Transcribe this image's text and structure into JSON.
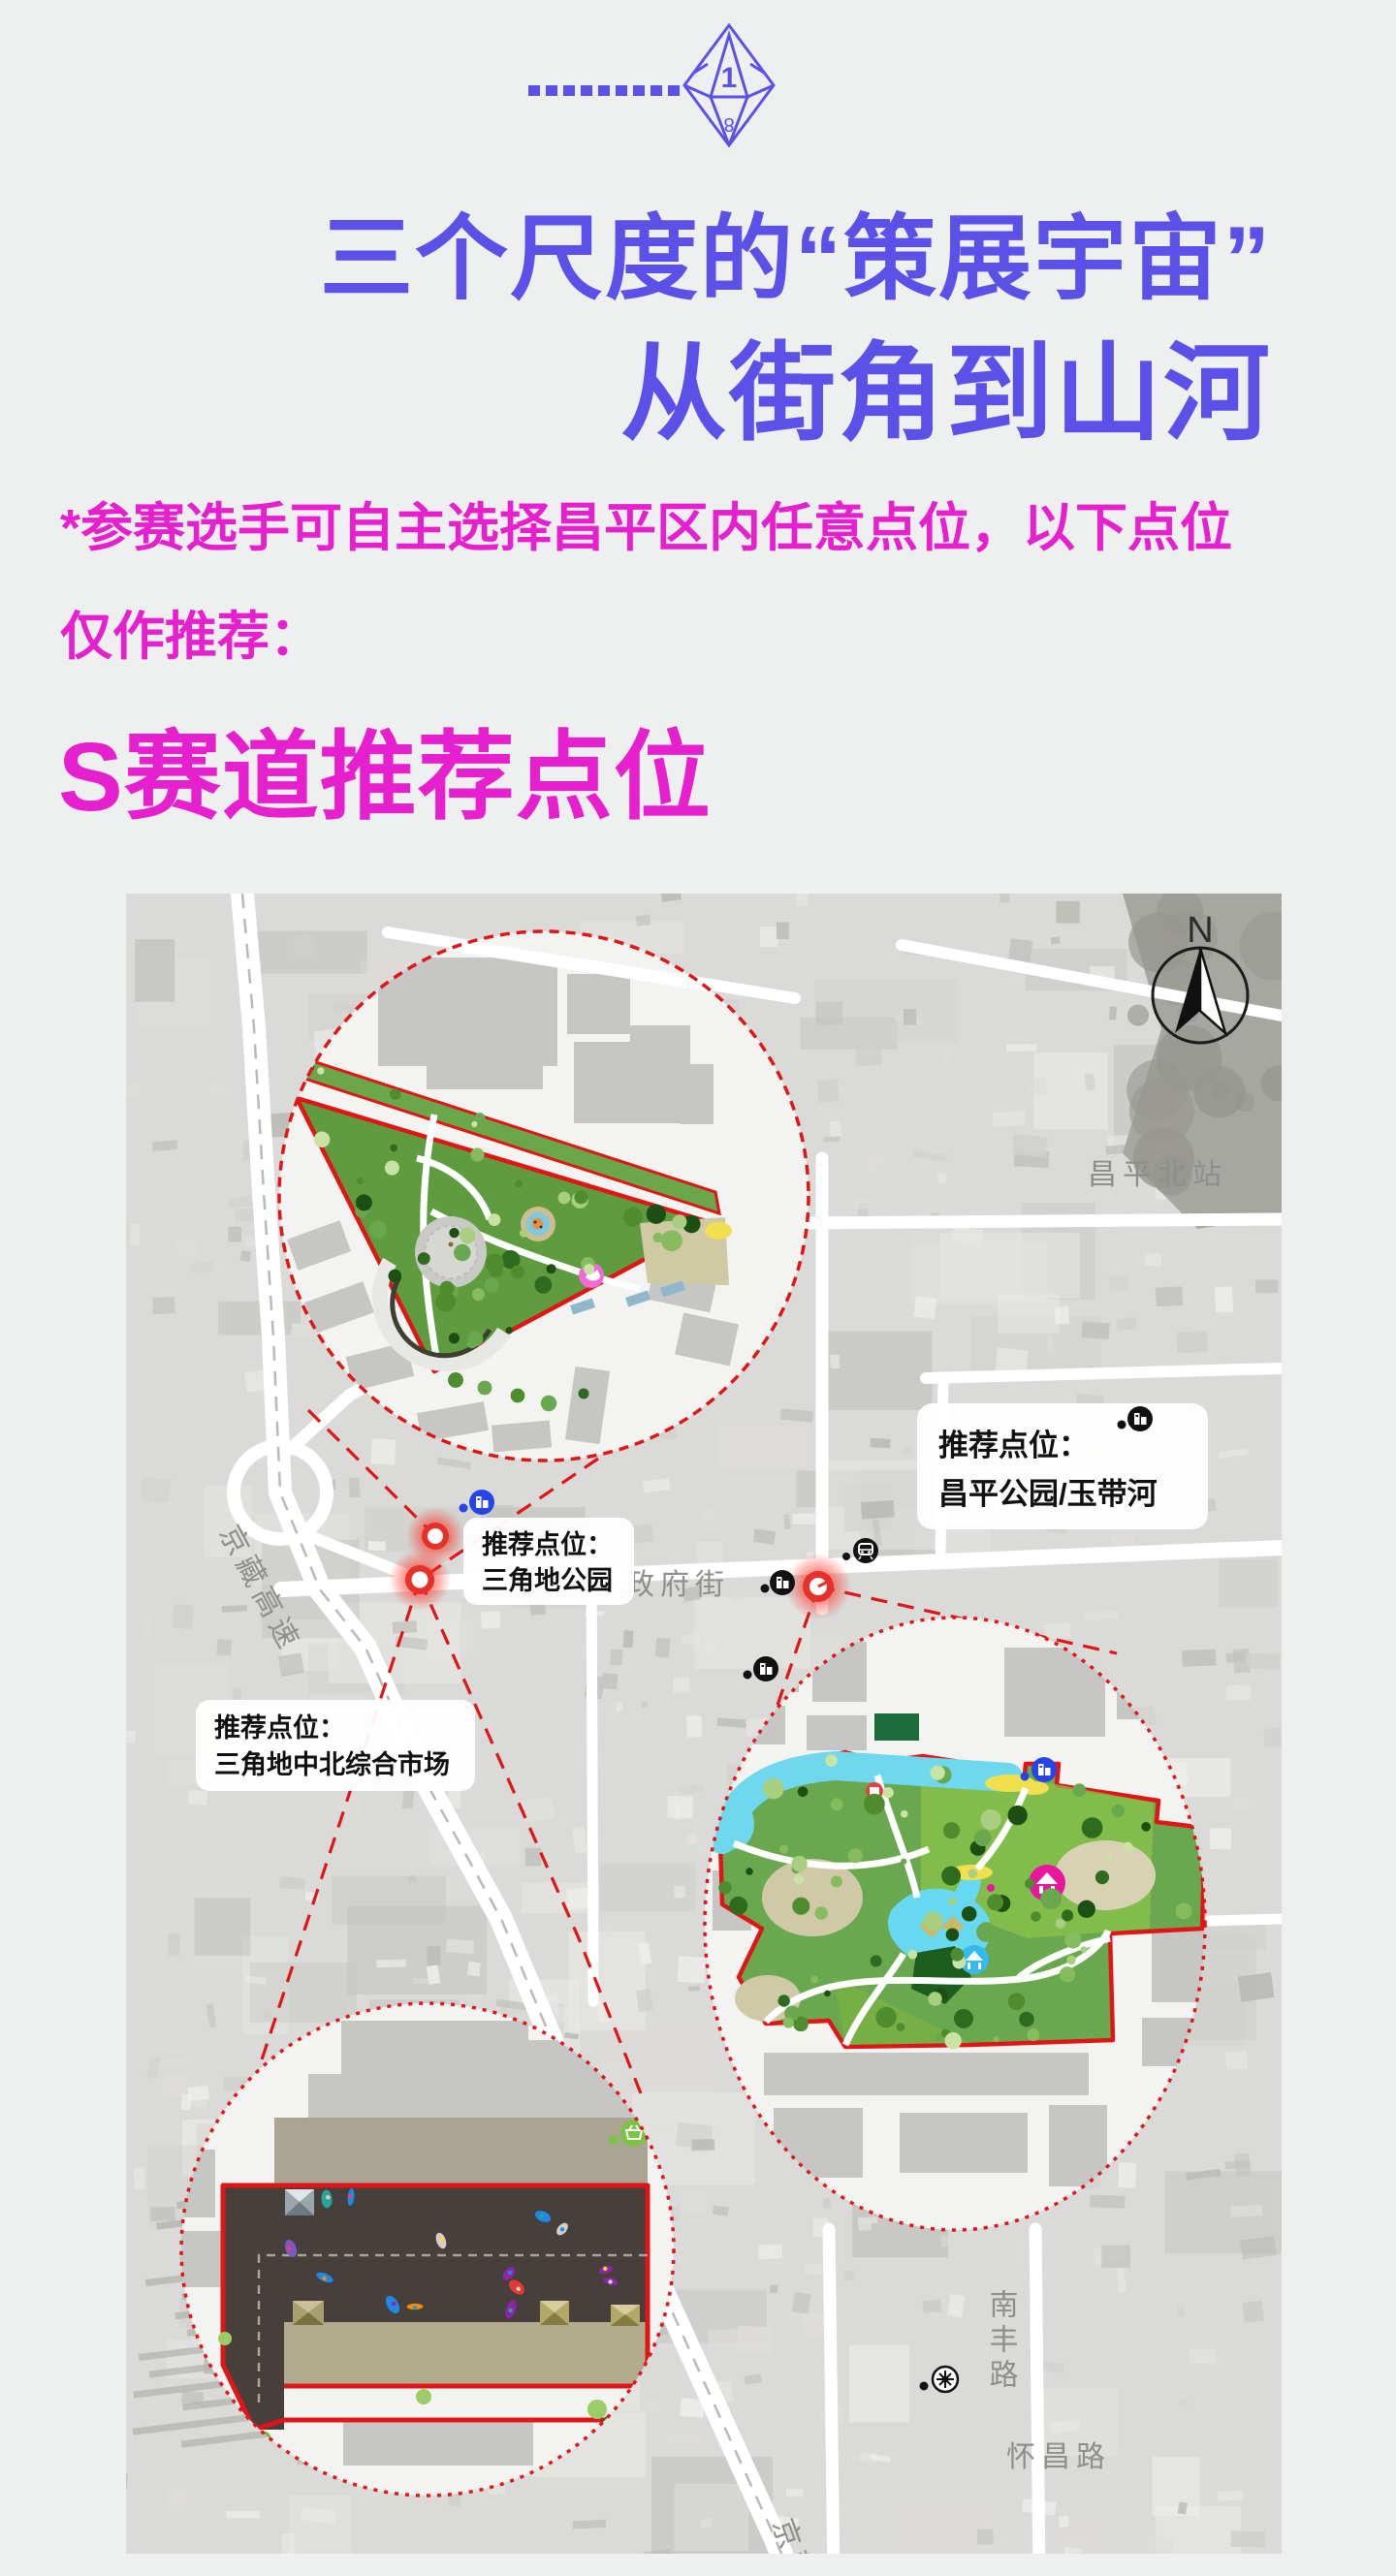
{
  "header": {
    "title_line1": "三个尺度的“策展宇宙”",
    "title_line2": "从街角到山河",
    "note_line1": "*参赛选手可自主选择昌平区内任意点位，以下点位",
    "note_line2": "仅作推荐：",
    "section_heading": "S赛道推荐点位",
    "gem_number": "1"
  },
  "map": {
    "compass_label": "N",
    "road_labels": {
      "jingzang_top": "京藏高速",
      "jingzang_bottom": "京藏高速",
      "zhengfu_street": "政府街",
      "changping_north_station": "昌平北站",
      "nanfeng_road": "南丰路",
      "huaichang_road": "怀昌路"
    },
    "callouts": {
      "triangle_park": {
        "line1": "推荐点位：",
        "line2": "三角地公园"
      },
      "market": {
        "line1": "推荐点位：",
        "line2": "三角地中北综合市场"
      },
      "changping_park": {
        "line1": "推荐点位：",
        "line2": "昌平公园/玉带河"
      }
    }
  },
  "colors": {
    "purple": "#5b50e8",
    "magenta": "#e620ce",
    "inset_red": "#e01616",
    "marker_red": "#e8302a",
    "park_green": "#5e9c3f",
    "park_green_light": "#8bc34a",
    "river_cyan": "#6fd8ef",
    "market_dark": "#463f3b",
    "khaki": "#b2ab8e",
    "icon_blue": "#2744e8",
    "icon_green": "#7cc243",
    "pink_pavilion": "#e8189c",
    "blue_pavilion": "#35b9f0"
  }
}
